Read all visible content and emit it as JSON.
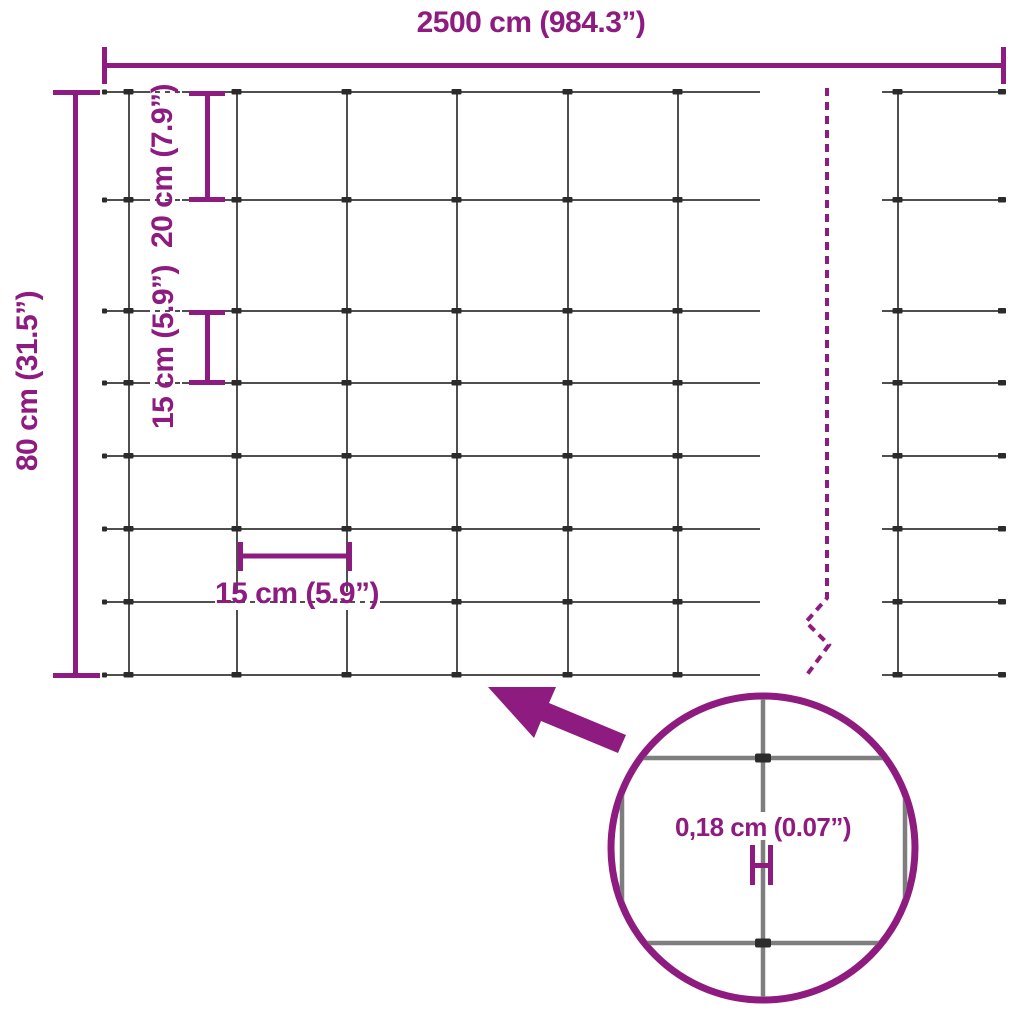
{
  "page": {
    "background": "#ffffff"
  },
  "colors": {
    "accent_purple": "#8e1b80",
    "wire_gray": "#4f4f4f",
    "node_dark": "#2b2b2b",
    "detail_wire_gray": "#7e7e7e"
  },
  "labels": {
    "total_width": "2500 cm (984.3”)",
    "total_height": "80 cm (31.5”)",
    "vertical_spacing_top": "20 cm (7.9”)",
    "vertical_spacing_middle": "15 cm (5.9”)",
    "horizontal_spacing": "15 cm (5.9”)",
    "wire_thickness": "0,18 cm (0.07”)"
  },
  "mesh": {
    "rows_y": [
      92,
      200,
      311,
      383,
      456,
      529,
      602,
      675
    ],
    "left_section": {
      "cols_x": [
        129,
        237,
        347,
        457,
        568,
        678
      ],
      "x_start": 104,
      "x_end": 760
    },
    "right_section": {
      "cols_x": [
        898
      ],
      "x_start": 882,
      "x_end": 1005
    }
  }
}
